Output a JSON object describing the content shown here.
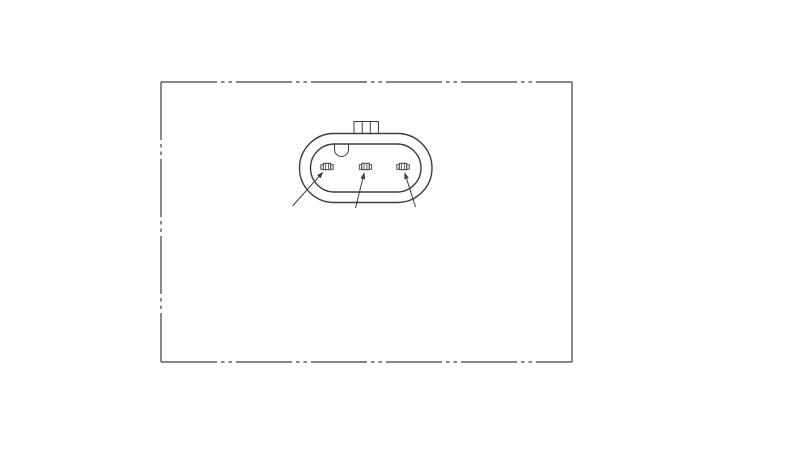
{
  "page": {
    "description": "Technical line drawing of a 3-pin automotive electrical connector face view, framed by a phantom-line (long-dash double-dot) border rectangle on a white canvas"
  },
  "colors": {
    "background": "#ffffff",
    "line": "#3d3d3d",
    "fill": "#ffffff"
  },
  "canvas": {
    "width": 800,
    "height": 451
  },
  "frame": {
    "x1": 161,
    "y1": 82,
    "x2": 572,
    "y2": 362,
    "phantom_dash": "56 4 3.5 4 3.5 4",
    "left_dash": "58 4 3.5 4 3.5 4",
    "sides": {
      "top": "phantom",
      "bottom": "phantom",
      "left": "phantom",
      "right": "solid"
    }
  },
  "connector": {
    "outer_body": {
      "x": 299.5,
      "y": 133.5,
      "w": 132.5,
      "h": 69,
      "r": 34.5
    },
    "inner_body": {
      "x": 310.5,
      "y": 144,
      "w": 110.5,
      "h": 48,
      "r": 24
    },
    "latch_tab": {
      "x": 354,
      "y": 121.5,
      "w": 24.5,
      "h": 13,
      "dividers_x": [
        362.2,
        370.3
      ]
    },
    "keying_notch": {
      "cx": 341.5,
      "top_y": 144,
      "drop": 5.5,
      "radius": 7
    },
    "pins": {
      "cy": 166.5,
      "cx": [
        327,
        365.5,
        403
      ],
      "body_w": 7.4,
      "body_h": 6.4,
      "ear_w": 2.5,
      "ear_h": 4.5,
      "rib_offset": 1.4
    },
    "leaders": [
      {
        "x1": 292.5,
        "y1": 206,
        "x2": 323.5,
        "y2": 171.5
      },
      {
        "x1": 355.5,
        "y1": 208,
        "x2": 364.5,
        "y2": 172
      },
      {
        "x1": 415.5,
        "y1": 207,
        "x2": 404.5,
        "y2": 172
      }
    ],
    "arrow": {
      "length": 7,
      "half_width": 2.3
    }
  },
  "stroke_widths": {
    "frame": 1.2,
    "outline": 1.4,
    "detail": 1.0,
    "leader": 1.0
  }
}
